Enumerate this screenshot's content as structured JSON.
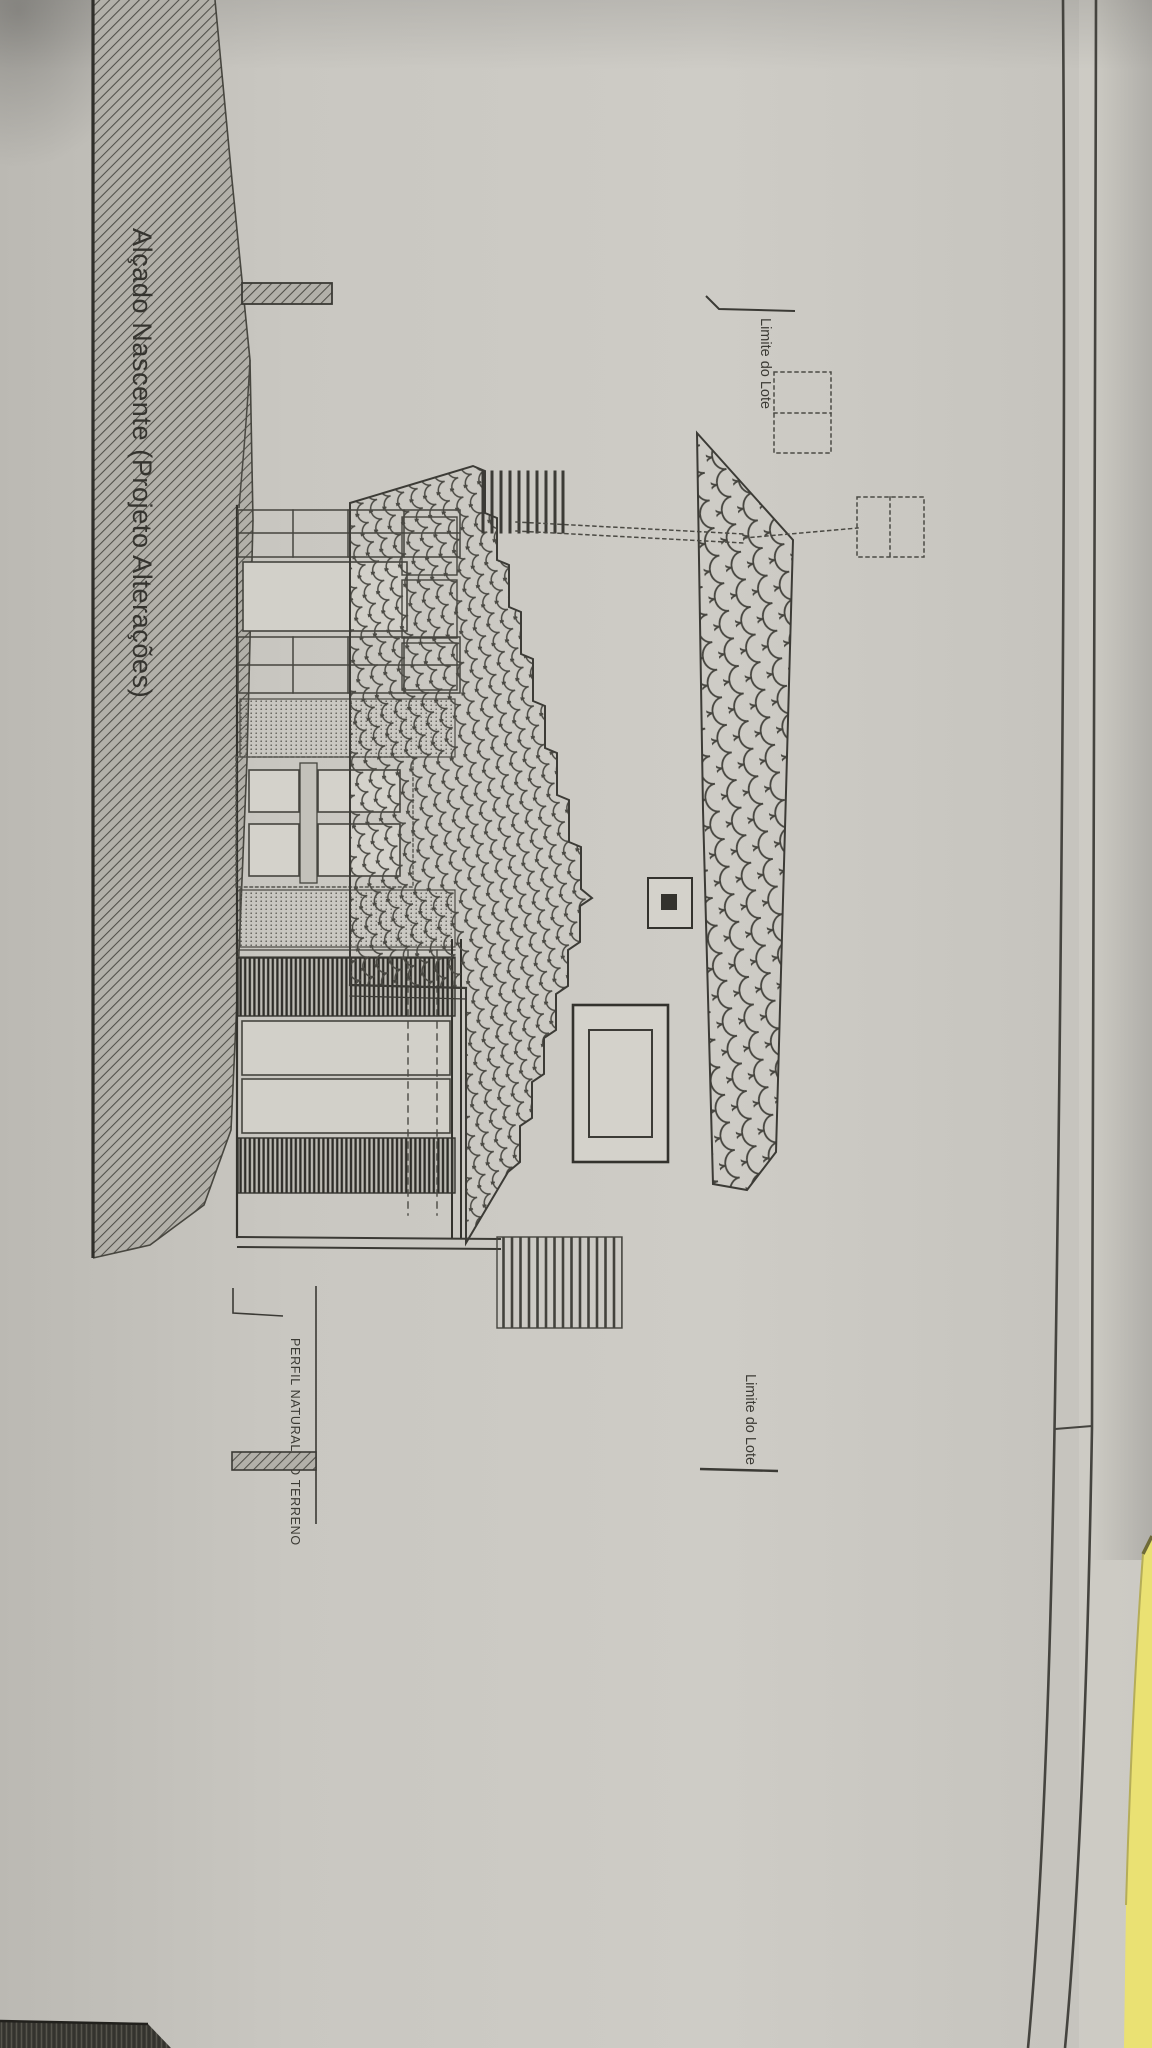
{
  "doc": {
    "kind": "photographed architectural elevation drawing, rotated 90°",
    "title": "Alçado Nascente (Projeto Alterações)",
    "labels": {
      "lot_top": "Limite do Lote",
      "lot_bottom": "Limite do Lote",
      "terrain": "PERFIL NATURAL DO TERRENO"
    },
    "colors": {
      "paper": "#c9c7c1",
      "paper_light": "#d4d2cb",
      "ink": "#3b3a35",
      "hatch_fill": "#b2b0a9",
      "sticky_note": "#eae173",
      "dark_strip": "#34332e"
    }
  }
}
